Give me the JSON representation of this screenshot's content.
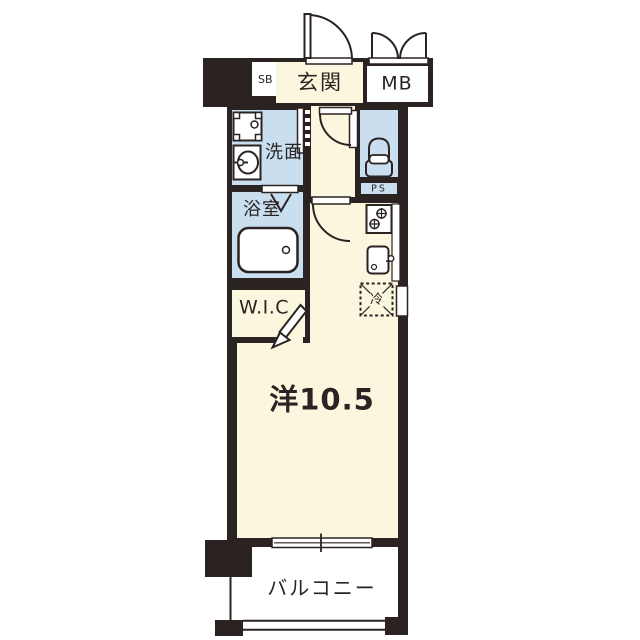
{
  "floorplan": {
    "labels": {
      "entrance": "玄関",
      "shoe_box": "SB",
      "mail_box": "MB",
      "washroom": "洗面",
      "bathroom": "浴室",
      "pipe_space": "PS",
      "walk_in_closet": "W.I.C",
      "main_room": "洋10.5",
      "refrigerator": "冷",
      "balcony": "バルコニー"
    },
    "colors": {
      "wall": "#2b2321",
      "cream": "#fbf7de",
      "blue": "#c9dff0",
      "white": "#ffffff",
      "text": "#2a2423"
    }
  }
}
